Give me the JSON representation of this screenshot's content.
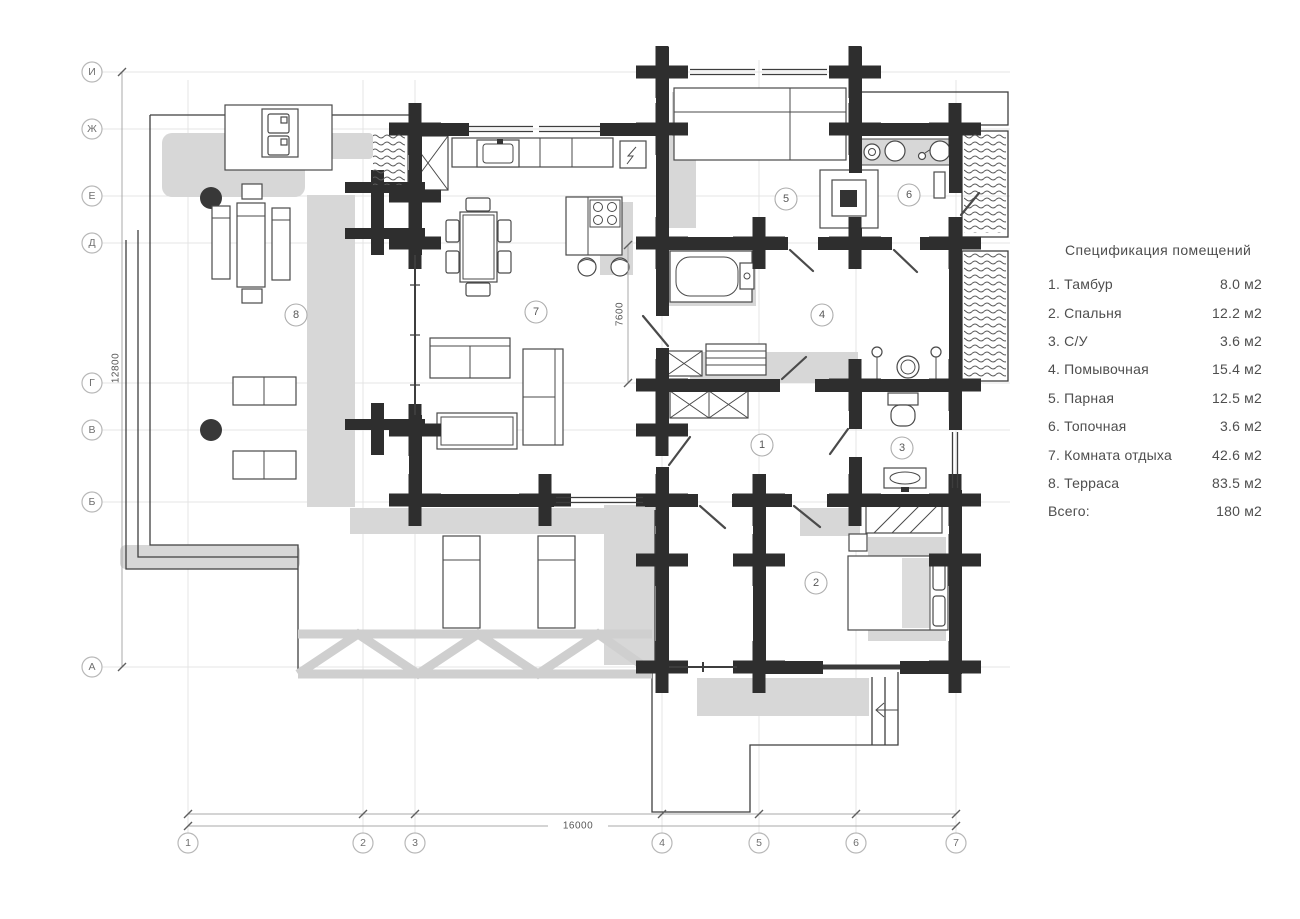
{
  "spec_table": {
    "title": "Спецификация помещений",
    "rows": [
      {
        "label": "1. Тамбур",
        "value": "8.0 м2"
      },
      {
        "label": "2. Спальня",
        "value": "12.2 м2"
      },
      {
        "label": "3. С/У",
        "value": "3.6 м2"
      },
      {
        "label": "4. Помывочная",
        "value": "15.4 м2"
      },
      {
        "label": "5. Парная",
        "value": "12.5 м2"
      },
      {
        "label": "6. Топочная",
        "value": "3.6 м2"
      },
      {
        "label": "7. Комната отдыха",
        "value": "42.6 м2"
      },
      {
        "label": "8. Терраса",
        "value": "83.5 м2"
      },
      {
        "label": "Всего:",
        "value": "180 м2"
      }
    ]
  },
  "axes": {
    "left": [
      "И",
      "Ж",
      "Е",
      "Д",
      "Г",
      "В",
      "Б",
      "А"
    ],
    "bottom": [
      "1",
      "2",
      "3",
      "4",
      "5",
      "6",
      "7"
    ]
  },
  "dimensions": {
    "overall_bottom": "16000",
    "overall_left": "12800",
    "interior": "7600"
  },
  "room_markers": [
    {
      "number": "1"
    },
    {
      "number": "2"
    },
    {
      "number": "3"
    },
    {
      "number": "4"
    },
    {
      "number": "5"
    },
    {
      "number": "6"
    },
    {
      "number": "7"
    },
    {
      "number": "8"
    }
  ],
  "colors": {
    "wall": "#2e2e2e",
    "shadow": "#d7d7d7",
    "line": "#4a4a4a",
    "grid": "#e4e4e4",
    "text": "#4e4e4e"
  }
}
